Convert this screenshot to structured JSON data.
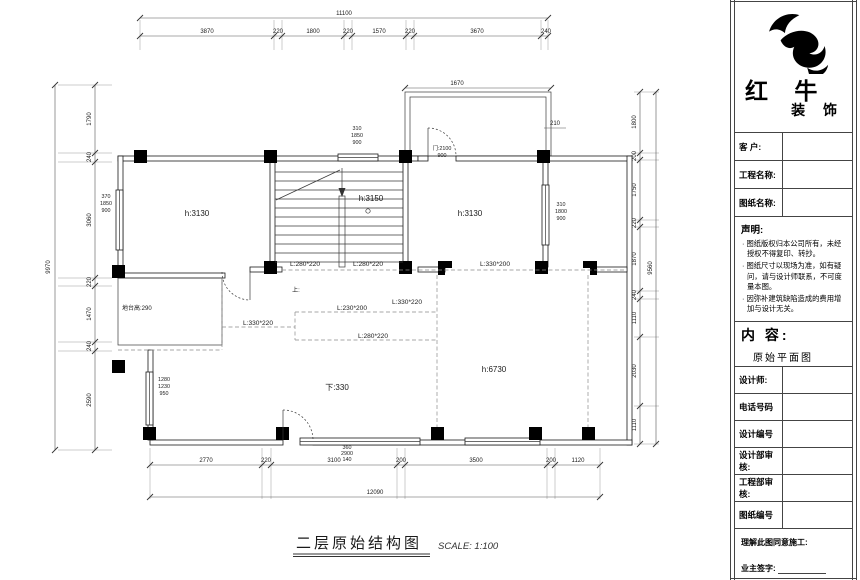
{
  "plan": {
    "dim_top": {
      "total": "11100",
      "segments": [
        "3870",
        "220",
        "1800",
        "220",
        "1570",
        "220",
        "3670",
        "240"
      ]
    },
    "dim_left": {
      "total": "9970",
      "segments": [
        "1790",
        "240",
        "3060",
        "220",
        "1470",
        "240",
        "2590"
      ]
    },
    "dim_right": {
      "total": "9560",
      "segments": [
        "1800",
        "200",
        "1750",
        "220",
        "1870",
        "240",
        "1110",
        "2030",
        "1110"
      ]
    },
    "dim_bottom": {
      "total": "12090",
      "segments": [
        "2770",
        "220",
        "3100",
        "200",
        "3500",
        "200",
        "1120"
      ]
    },
    "balcony_width": "1670",
    "balcony_side": "210",
    "door_label": {
      "line1": "门:2100",
      "line2": "900"
    },
    "window_specs": {
      "left": [
        "370",
        "1850",
        "900"
      ],
      "top": [
        "310",
        "1850",
        "900"
      ],
      "right": [
        "310",
        "1800",
        "900"
      ],
      "lower_left": [
        "1280",
        "1230",
        "950"
      ],
      "bottom": [
        "360",
        "2900",
        "140"
      ]
    },
    "rooms": {
      "left_room": "h:3130",
      "stair_room": "h:3150",
      "right_room": "h:3130",
      "living": "h:6730",
      "step_down": "下:330",
      "platform": "地台高:290",
      "stair_up": "上:"
    },
    "beams": [
      "L:280*220",
      "L:280*220",
      "L:330*200",
      "L:230*200",
      "L:330*220",
      "L:330*220",
      "L:280*220"
    ],
    "title": "二层原始结构图",
    "scale": "SCALE: 1:100"
  },
  "title_block": {
    "brand": {
      "line1": "红 牛",
      "line2": "装 饰"
    },
    "fields": [
      {
        "label": "客  户:"
      },
      {
        "label": "工程名称:"
      },
      {
        "label": "图纸名称:"
      }
    ],
    "statement": {
      "heading": "声明:",
      "items": [
        "图纸版权归本公司所有，未经授权不得复印、转抄。",
        "图纸尺寸以现场为准，如有疑问，请与设计师联系，不可度量本图。",
        "因弥补建筑缺陷造成的费用增加与设计无关。"
      ]
    },
    "content": {
      "heading": "内 容:",
      "value": "原始平面图"
    },
    "fields2": [
      {
        "label": "设计师:"
      },
      {
        "label": "电话号码"
      },
      {
        "label": "设计编号"
      },
      {
        "label": "设计部审核:"
      },
      {
        "label": "工程部审核:"
      },
      {
        "label": "图纸编号"
      }
    ],
    "footer": {
      "line1": "理解此图同意施工:",
      "line2": "业主签字:"
    }
  }
}
